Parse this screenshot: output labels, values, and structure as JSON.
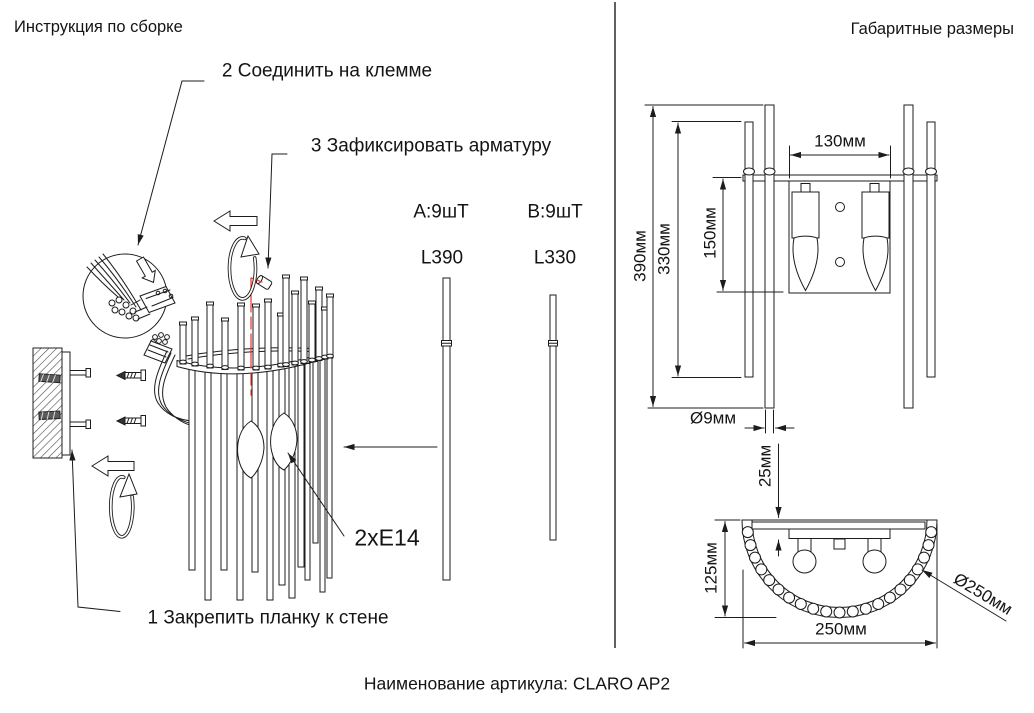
{
  "header": {
    "left_title": "Инструкция по сборке",
    "right_title": "Габаритные размеры"
  },
  "assembly": {
    "step_1": "1 Закрепить планку к стене",
    "step_2": "2 Соединить на клемме",
    "step_3": "3 Зафиксировать арматуру",
    "socket_label": "2xE14",
    "parts": [
      {
        "id": "A",
        "qty": "A:9шТ",
        "length": "L390"
      },
      {
        "id": "B",
        "qty": "B:9шТ",
        "length": "L330"
      }
    ]
  },
  "dimensions": {
    "front_view": {
      "overall_height": "390мм",
      "rod_b_height": "330мм",
      "body_height": "150мм",
      "plate_width": "130мм",
      "rod_diameter": "Ø9мм"
    },
    "top_view": {
      "wall_offset": "25мм",
      "depth": "125мм",
      "width": "250мм",
      "diameter": "Ø250мм"
    }
  },
  "footer": {
    "caption": "Наименование артикула: CLARO AP2"
  },
  "colors": {
    "ink": "#1c1c1c",
    "accent": "#e8322a"
  }
}
